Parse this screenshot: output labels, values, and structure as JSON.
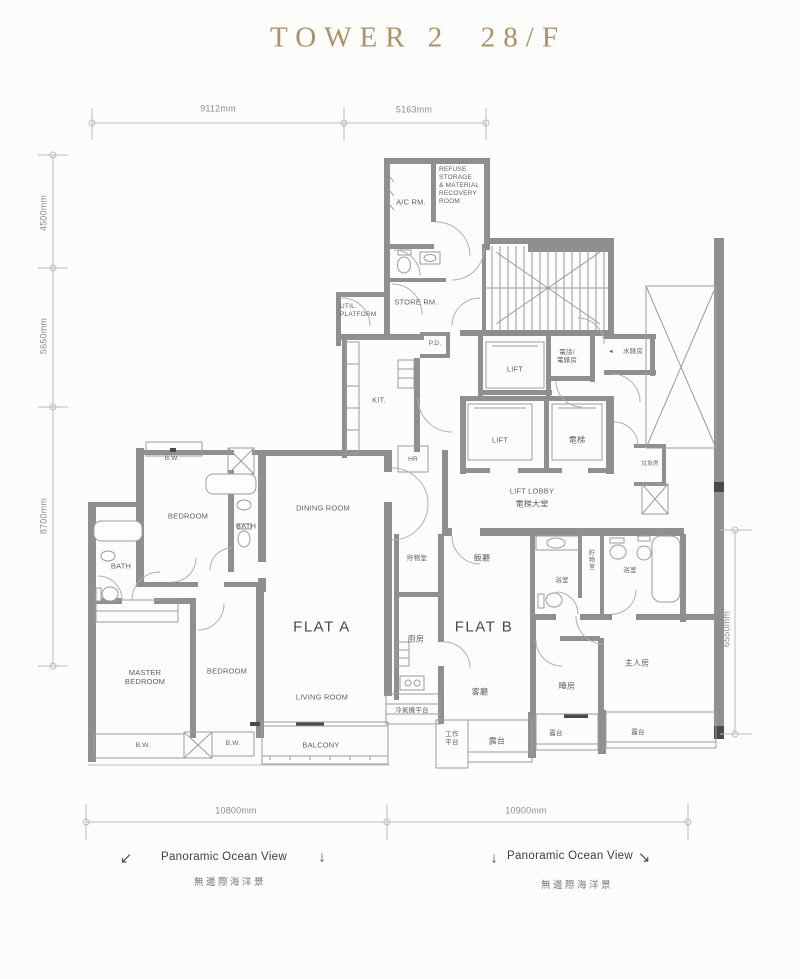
{
  "title": "TOWER 2  28/F",
  "dimensions": {
    "top": [
      "9112mm",
      "5163mm"
    ],
    "left": [
      "4500mm",
      "5650mm",
      "8700mm"
    ],
    "right": [
      "6550mm"
    ],
    "bottom": [
      "10800mm",
      "10900mm"
    ]
  },
  "core": {
    "ac_room": "A/C RM.",
    "refuse_room": "REFUSE STORAGE\n& MATERIAL\nRECOVERY\nROOM",
    "store_room": "STORE RM.",
    "util_platform": "UTIL.\nPLATFORM",
    "pipe_duct": "P.D.",
    "kitchen": "KIT.",
    "hose_reel": "HR",
    "lift": "LIFT",
    "lift_cn": "電梯",
    "tel_meter_room": "電話/\n電錶房",
    "water_meter_room": "水錶房",
    "water_meter_arrow": "◄",
    "lift_lobby": "LIFT LOBBY",
    "lift_lobby_cn": "電梯大堂",
    "refuse_chute": "垃圾房"
  },
  "flat_a": {
    "name": "FLAT A",
    "dining_room": "DINING ROOM",
    "living_room": "LIVING ROOM",
    "balcony": "BALCONY",
    "bedroom": "BEDROOM",
    "master_bedroom": "MASTER\nBEDROOM",
    "bath": "BATH",
    "bay_window": "B.W."
  },
  "flat_b": {
    "name": "FLAT B",
    "dining_room_cn": "飯廳",
    "living_room_cn": "客廳",
    "kitchen_cn": "廚房",
    "store_cn": "貯物室",
    "bath_cn": "浴室",
    "bedroom_cn": "睡房",
    "master_bedroom_cn": "主人房",
    "balcony_cn": "露台",
    "utility_platform_cn": "工作\n平台",
    "ac_platform_cn": "冷氣機平台"
  },
  "view_notes": {
    "left": {
      "arrow_a": "↙",
      "label": "Panoramic Ocean View",
      "label_cn": "無邊際海洋景",
      "arrow_b": "↓"
    },
    "right": {
      "arrow_a": "↓",
      "label": "Panoramic Ocean View",
      "label_cn": "無邊際海洋景",
      "arrow_b": "↘"
    }
  }
}
